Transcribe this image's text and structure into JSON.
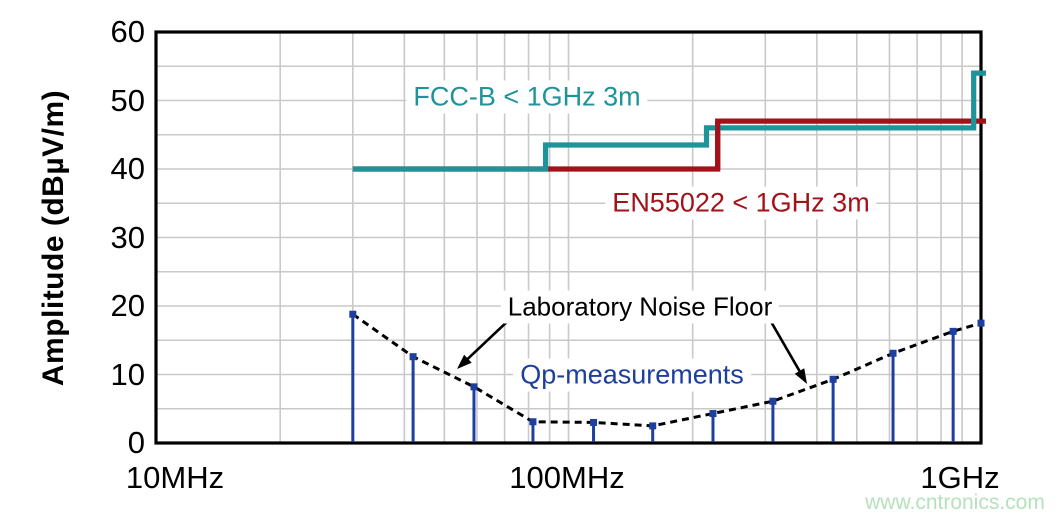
{
  "watermark": {
    "text": "www.cntronics.com",
    "color": "#b5e2bd"
  },
  "chart_data": {
    "type": "line",
    "title": "",
    "xlabel": "",
    "ylabel": "Amplitude (dBµV/m)",
    "x_axis": {
      "scale": "log",
      "unit": "MHz",
      "range": [
        10,
        1000
      ],
      "tick_values": [
        10,
        100,
        1000
      ],
      "tick_labels": [
        "10MHz",
        "100MHz",
        "1GHz"
      ],
      "minor_grid": "log sub-decades 2-9"
    },
    "y_axis": {
      "range": [
        0,
        60
      ],
      "tick_step": 10,
      "grid_step": 5,
      "tick_labels": [
        "60",
        "50",
        "40",
        "30",
        "20",
        "10",
        "0"
      ]
    },
    "grid": true,
    "grid_color": "#c9c9c9",
    "legend_position": "inline text annotations",
    "series": [
      {
        "name": "EN55022 < 1GHz 3m",
        "type": "step-line",
        "color": "#a31218",
        "points_mhz_db": [
          [
            30,
            40
          ],
          [
            230,
            40
          ],
          [
            230,
            47
          ],
          [
            1000,
            47
          ]
        ]
      },
      {
        "name": "FCC-B < 1GHz 3m",
        "type": "step-line",
        "color": "#1d9499",
        "points_mhz_db": [
          [
            30,
            40
          ],
          [
            88,
            40
          ],
          [
            88,
            43.5
          ],
          [
            216,
            43.5
          ],
          [
            216,
            46
          ],
          [
            960,
            46
          ],
          [
            960,
            54
          ],
          [
            1000,
            54
          ]
        ]
      },
      {
        "name": "Laboratory Noise Floor",
        "type": "dashed-line",
        "color": "#000000",
        "points_mhz_db": [
          [
            30,
            18.8
          ],
          [
            42,
            12.6
          ],
          [
            59,
            8.2
          ],
          [
            82,
            3.1
          ],
          [
            115,
            3.0
          ],
          [
            160,
            2.5
          ],
          [
            224,
            4.3
          ],
          [
            313,
            6.1
          ],
          [
            438,
            9.3
          ],
          [
            612,
            13.1
          ],
          [
            856,
            16.3
          ],
          [
            1000,
            17.5
          ]
        ]
      },
      {
        "name": "Qp-measurements",
        "type": "stem",
        "color": "#1e3f9e",
        "marker": "square",
        "points_mhz_db": [
          [
            30,
            18.8
          ],
          [
            42,
            12.6
          ],
          [
            59,
            8.2
          ],
          [
            82,
            3.1
          ],
          [
            115,
            3.0
          ],
          [
            160,
            2.5
          ],
          [
            224,
            4.3
          ],
          [
            313,
            6.1
          ],
          [
            438,
            9.3
          ],
          [
            612,
            13.1
          ],
          [
            856,
            16.3
          ]
        ]
      }
    ]
  }
}
